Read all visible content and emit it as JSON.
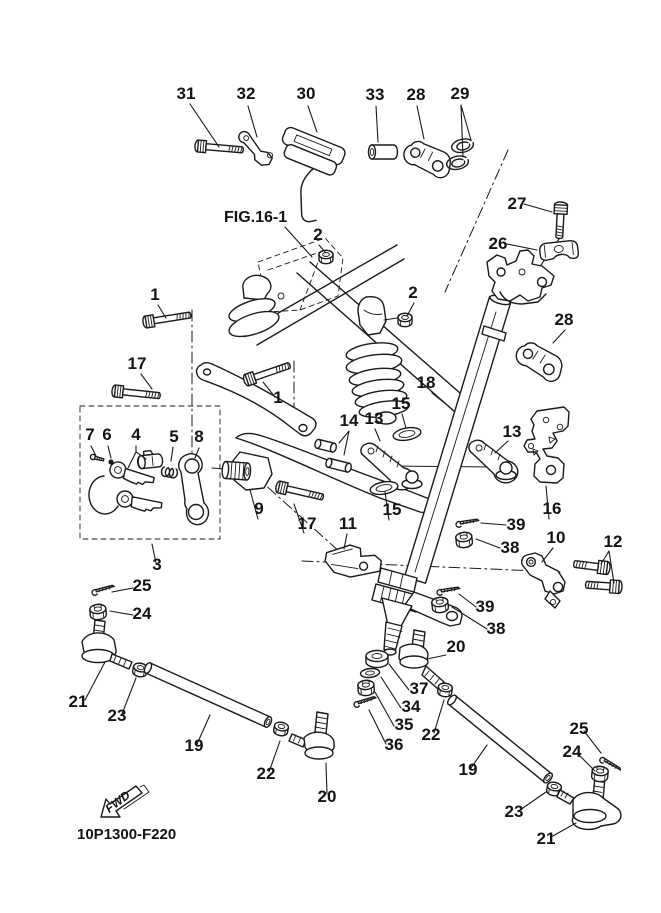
{
  "figure": {
    "reference": "FIG.16-1",
    "code": "10P1300-F220",
    "fwd": "FWD"
  },
  "colors": {
    "line": "#1a1a1a",
    "background": "#ffffff"
  },
  "callouts": [
    "31",
    "32",
    "30",
    "33",
    "28",
    "29",
    "27",
    "2",
    "26",
    "2",
    "28",
    "1",
    "17",
    "18",
    "1",
    "15",
    "13",
    "14",
    "13",
    "7",
    "6",
    "4",
    "5",
    "8",
    "16",
    "9",
    "15",
    "17",
    "11",
    "39",
    "10",
    "12",
    "38",
    "3",
    "25",
    "39",
    "24",
    "38",
    "20",
    "37",
    "21",
    "34",
    "23",
    "35",
    "25",
    "22",
    "36",
    "19",
    "24",
    "19",
    "22",
    "20",
    "23",
    "21"
  ]
}
